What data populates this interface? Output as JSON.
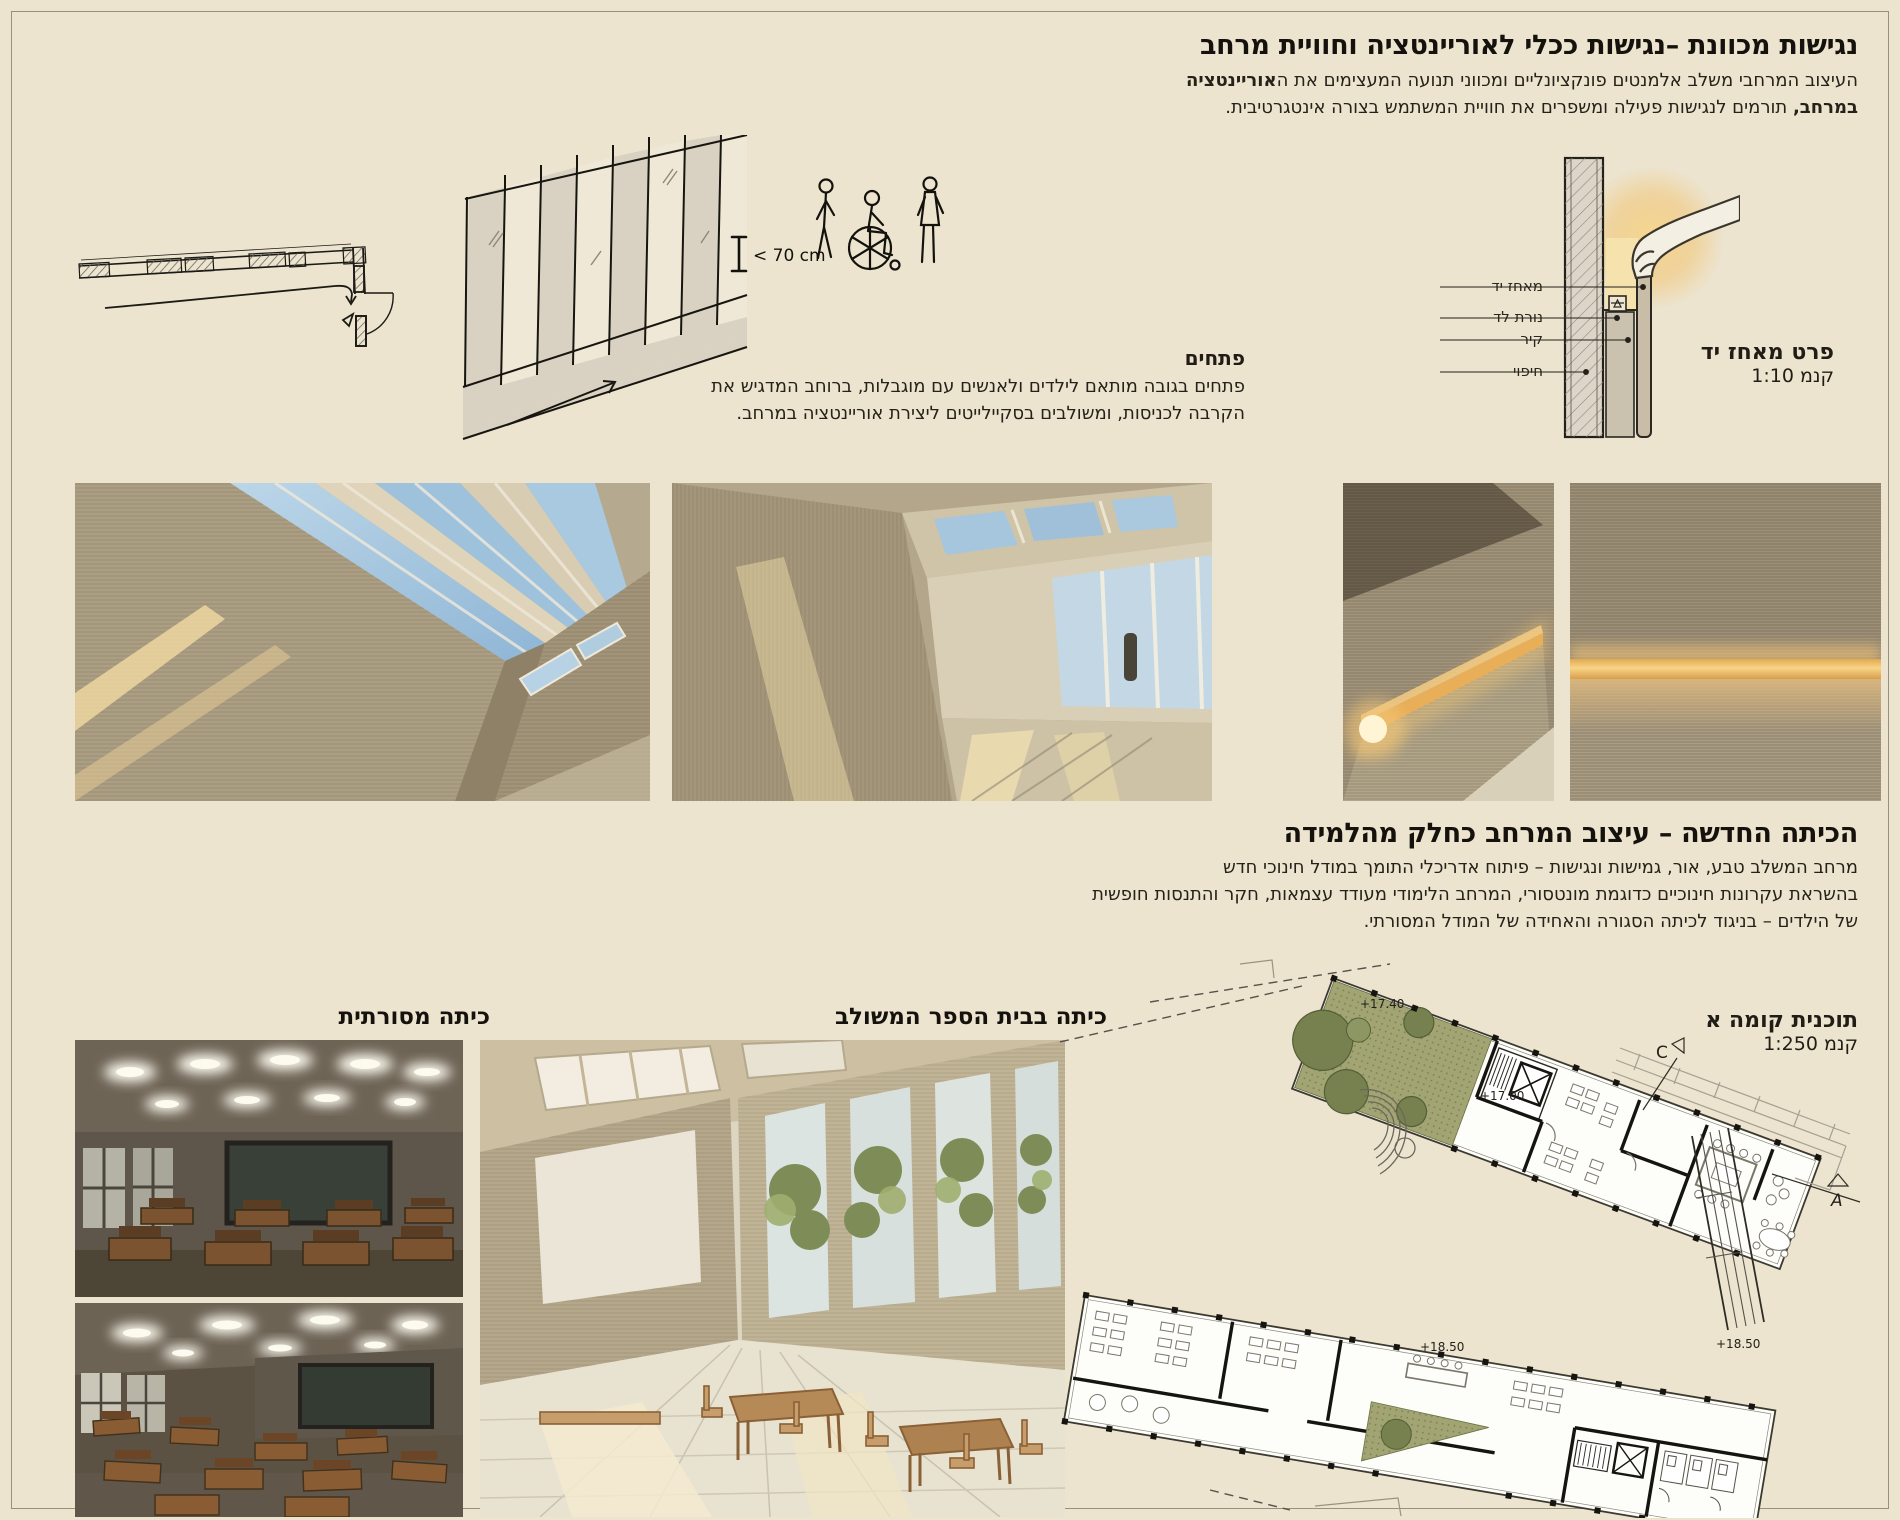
{
  "header": {
    "title": "נגישות מכוונת –נגישות ככלי לאוריינטציה וחוויית מרחב",
    "line1_regular": "העיצוב המרחבי משלב אלמנטים פונקציונליים ומכווני תנועה המעצימים את ה",
    "line1_bold": "אוריינטציה",
    "line2_bold": "במרחב,",
    "line2_regular": " תורמים לנגישות פעילה ומשפרים את חוויית המשתמש בצורה אינטגרטיבית."
  },
  "openings": {
    "heading": "פתחים",
    "line1": "פתחים בגובה מותאם לילדים ולאנשים עם מוגבלות, ברוחב המדגיש  את",
    "line2": "הקרבה לכניסות, ומשולבים בסקיילייטים ליצירת אוריינטציה במרחב."
  },
  "sketch": {
    "measure_label": "< 70 cm"
  },
  "handrail": {
    "label_handle": "מאחז יד",
    "label_led": "נורת לד",
    "label_wall": "קיר",
    "label_cladding": "חיפוי",
    "caption_title": "פרט מאחז יד",
    "caption_scale": "קנמ 1:10"
  },
  "classroom": {
    "title": "הכיתה החדשה – עיצוב המרחב כחלק מהלמידה",
    "line1": "מרחב המשלב טבע, אור, גמישות ונגישות – פיתוח אדריכלי התומך במודל חינוכי חדש",
    "line2": "בהשראת עקרונות חינוכיים כדוגמת מונטסורי, המרחב הלימודי מעודד עצמאות, חקר והתנסות חופשית",
    "line3": "של הילדים – בניגוד לכיתה הסגורה והאחידה של המודל המסורתי."
  },
  "plan": {
    "caption_title": "תוכנית קומה א",
    "caption_scale": "קנמ 1:250",
    "level_a": "+17.40",
    "level_b": "+17.00",
    "level_c": "+18.50",
    "level_d": "+18.50",
    "marker_c": "C",
    "marker_a": "A"
  },
  "captions": {
    "traditional": "כיתה מסורתית",
    "integrated": "כיתה בבית הספר המשולב"
  },
  "colors": {
    "background": "#ece4cf",
    "wall_render": "#ab9e83",
    "sky": "#9fc2dc",
    "led_glow": "#f0bd66",
    "plan_green": "#a2a573",
    "text": "#211d16"
  }
}
